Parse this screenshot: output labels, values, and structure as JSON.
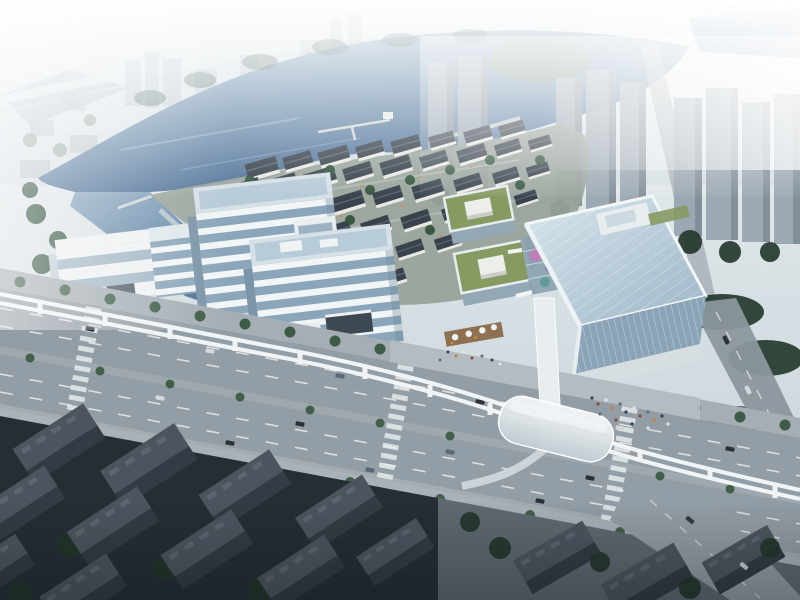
{
  "image": {
    "type": "architectural-aerial-rendering",
    "description": "Aerial architectural rendering of a lakeside mixed-use development: a retail village with dark pitched roofs, stepped glass office buildings, green-roof podium blocks, a tall glass office tower, a tree-lined boulevard with an elevated monorail line and a vaulted station, hazy high-rise residential towers around a lake, and dark existing low-rise blocks in the foreground."
  },
  "colors": {
    "sky_top": "#f1f5f6",
    "sky_bottom": "#c6d1d7",
    "distant_building": "#b4c0c7",
    "hazy_tower": "#9aa7b1",
    "hazy_tower_shade": "#7d8a94",
    "water_light": "#8fa9c0",
    "water_mid": "#6d8fae",
    "water_deep": "#4e7096",
    "shore_reflection": "#3f5a55",
    "green_bank": "#7a8f74",
    "tree_dark": "#22362a",
    "tree_mid": "#33543f",
    "tree_street": "#3c5c45",
    "haze_green": "#7a9183",
    "village_roof": "#39424d",
    "village_ridge": "#5a646f",
    "village_wall": "#e9e9e4",
    "warm_light": "#d9893b",
    "glass_top": "#d5e0e7",
    "glass_sky": "#b7cbd8",
    "glass_band_white": "#f1f5f6",
    "glass_band_blue": "#8ba6ba",
    "glass_side": "#7b95a8",
    "white_facade": "#eef1f2",
    "green_roof": "#869a62",
    "roof_box": "#eceee9",
    "courtyard_glass": "#8ca2b0",
    "accent_pink": "#c07fb8",
    "accent_purple": "#7f6fa8",
    "accent_teal": "#5f9c96",
    "tower_facade": "#8aa3b6",
    "road": "#939da5",
    "road_dark": "#848e96",
    "sidewalk": "#a5aeb4",
    "plaza": "#b4bcc1",
    "lane_mark": "#eceff1",
    "rail_white": "#f0f4f6",
    "deck_wood": "#8a6a4a",
    "dark_ground": "#262d35",
    "dark_block_top": "#4c555e",
    "dark_block_side": "#333b44",
    "lit_block_top": "#5a646d",
    "lit_block_side": "#3f474f",
    "paved_dark": "#5f6971",
    "car_dark": "#2b3138",
    "car_light": "#d3d8db"
  },
  "scene": {
    "regions": [
      {
        "name": "lake",
        "label": "Lake with pier and curved waterfront promenade"
      },
      {
        "name": "distant-city",
        "label": "Hazy distant city with elevated viaduct"
      },
      {
        "name": "village-cluster",
        "label": "Retail village with dark pitched roofs and white walls"
      },
      {
        "name": "office-buildings",
        "label": "Stepped glass office buildings with white bands"
      },
      {
        "name": "green-roof-podiums",
        "label": "Podium blocks with green roofs and skylight boxes"
      },
      {
        "name": "glass-tower",
        "label": "High-rise glass office tower with diagonal grid"
      },
      {
        "name": "boulevard",
        "label": "Tree-lined boulevard with traffic and crosswalks"
      },
      {
        "name": "monorail",
        "label": "Elevated dual-track monorail with vaulted station and footbridge"
      },
      {
        "name": "east-residential-towers",
        "label": "Residential tower clusters in haze"
      },
      {
        "name": "south-residential",
        "label": "Existing low-rise blocks in shadow"
      }
    ]
  }
}
